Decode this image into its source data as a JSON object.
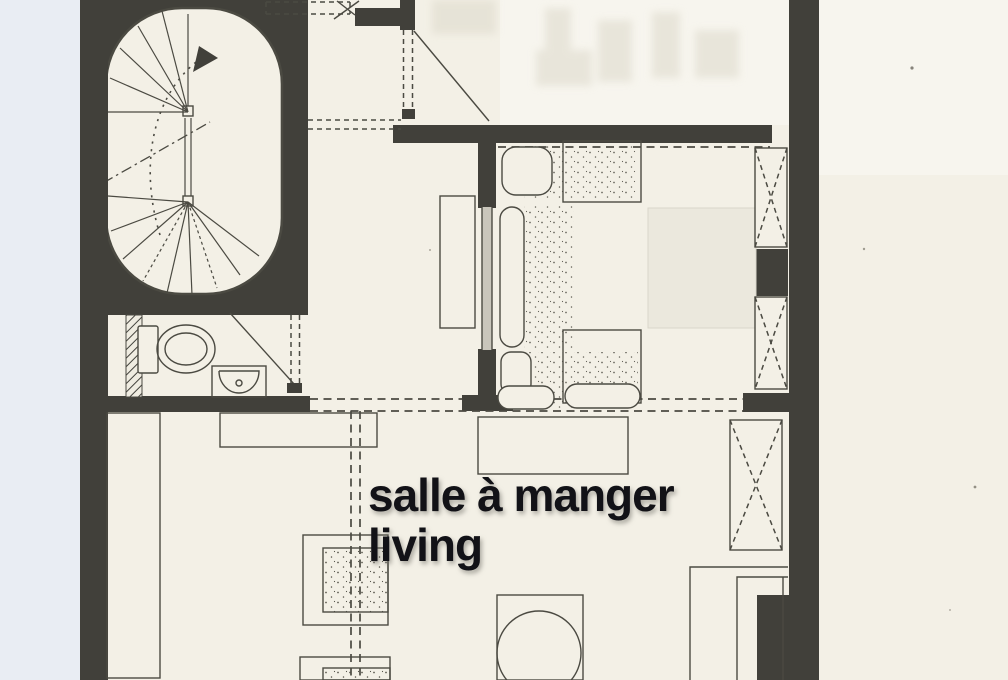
{
  "plan": {
    "labels": {
      "line1": "salle à manger",
      "line2": "living"
    },
    "colors": {
      "paper": "#f3f0e6",
      "paper_bright": "#f7f5ee",
      "margin": "#e9edf3",
      "wall": "#41403a",
      "line": "#4b4a42",
      "text": "#121217"
    },
    "features": [
      "spiral-staircase",
      "direction-arrow",
      "entry-door-swing",
      "wc-toilet",
      "washbasin",
      "bathroom-door-swing",
      "sofa",
      "bed",
      "window-x-symbol",
      "sideboard",
      "bench",
      "wall-counter",
      "side-table",
      "round-dining-table",
      "kitchen-counter",
      "hatched-partition",
      "dashed-opening-lines"
    ]
  }
}
